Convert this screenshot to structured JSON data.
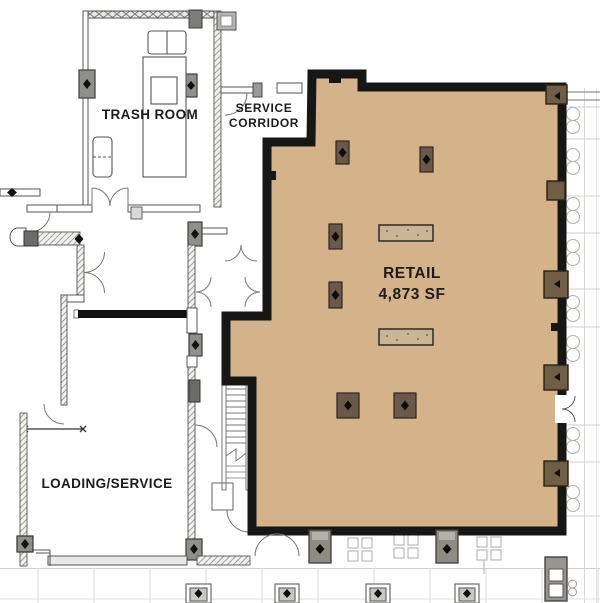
{
  "page": {
    "type": "architectural floor plan",
    "background": "#ffffff"
  },
  "labels": {
    "trash_room": "TRASH ROOM",
    "service_corridor": [
      "SERVICE",
      "CORRIDOR"
    ],
    "retail_name": "RETAIL",
    "retail_area": "4,873 SF",
    "loading_service": "LOADING/SERVICE"
  },
  "colors": {
    "retail_fill": "#d4b28a",
    "retail_wall": "#161616",
    "wall_column": "#6f5d45",
    "interior_column": "#6a594a",
    "fixture": "#c9b493",
    "thin_wall": "#5a5a58",
    "hatch_line": "#a0a09c",
    "exterior_line": "#cfcfcc",
    "furniture_line": "#b0b0ad",
    "label_text": "#1b1b1b"
  },
  "icons": {
    "column_marker": "column-diamond-icon",
    "door": "door-swing-arc",
    "stairs": "stair-treads"
  }
}
